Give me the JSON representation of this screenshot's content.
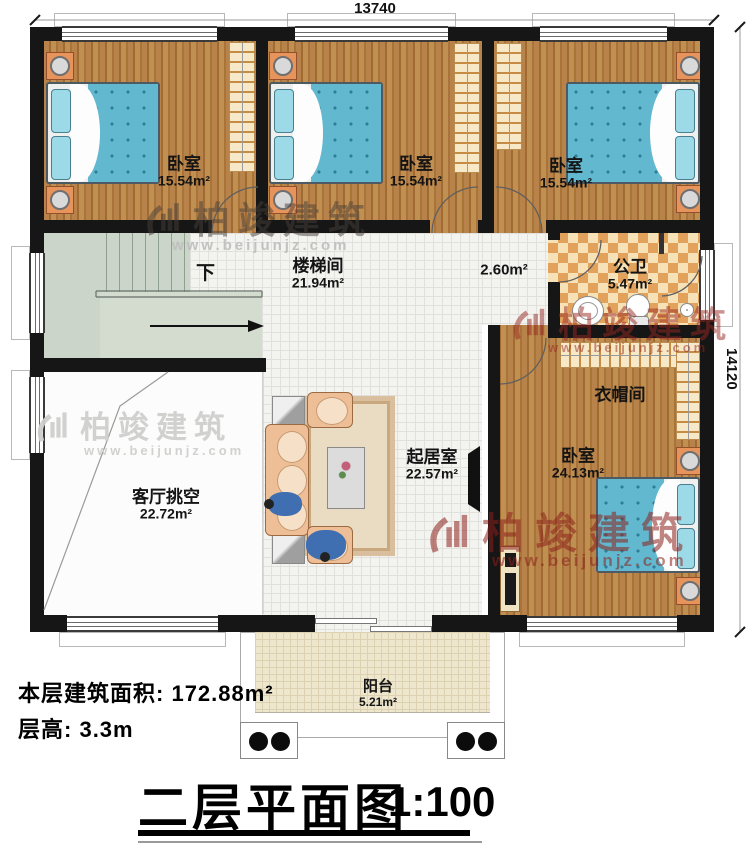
{
  "title": {
    "text": "二层平面图",
    "scale": "1:100"
  },
  "dimensions": {
    "top": "13740",
    "right": "14120"
  },
  "info": {
    "area_label": "本层建筑面积:",
    "area_value": "172.88m²",
    "height_label": "层高:",
    "height_value": "3.3m"
  },
  "rooms": {
    "bedroom1": {
      "name": "卧室",
      "area": "15.54m²"
    },
    "bedroom2": {
      "name": "卧室",
      "area": "15.54m²"
    },
    "bedroom3": {
      "name": "卧室",
      "area": "15.54m²"
    },
    "stairwell": {
      "name": "楼梯间",
      "area": "21.94m²"
    },
    "corridor": {
      "area": "2.60m²"
    },
    "bathroom": {
      "name": "公卫",
      "area": "5.47m²"
    },
    "cloakroom": {
      "name": "衣帽间"
    },
    "bedroom4": {
      "name": "卧室",
      "area": "24.13m²"
    },
    "living": {
      "name": "起居室",
      "area": "22.57m²"
    },
    "void": {
      "name": "客厅挑空",
      "area": "22.72m²"
    },
    "balcony": {
      "name": "阳台",
      "area": "5.21m²"
    },
    "stair_direction": "下"
  },
  "watermark": {
    "brand": "柏竣建筑",
    "url": "www.beijunjz.com"
  },
  "colors": {
    "wall": "#161616",
    "wood_floor": "#b0793c",
    "tile_floor": "#f3f3f0",
    "bath_tile_a": "#e2a25c",
    "bath_tile_b": "#f6e2b6",
    "stair": "#ccd5c9",
    "bed_quilt": "#62b8cf",
    "watermark_red": "#8c201c",
    "watermark_gray": "#cdcdca"
  }
}
